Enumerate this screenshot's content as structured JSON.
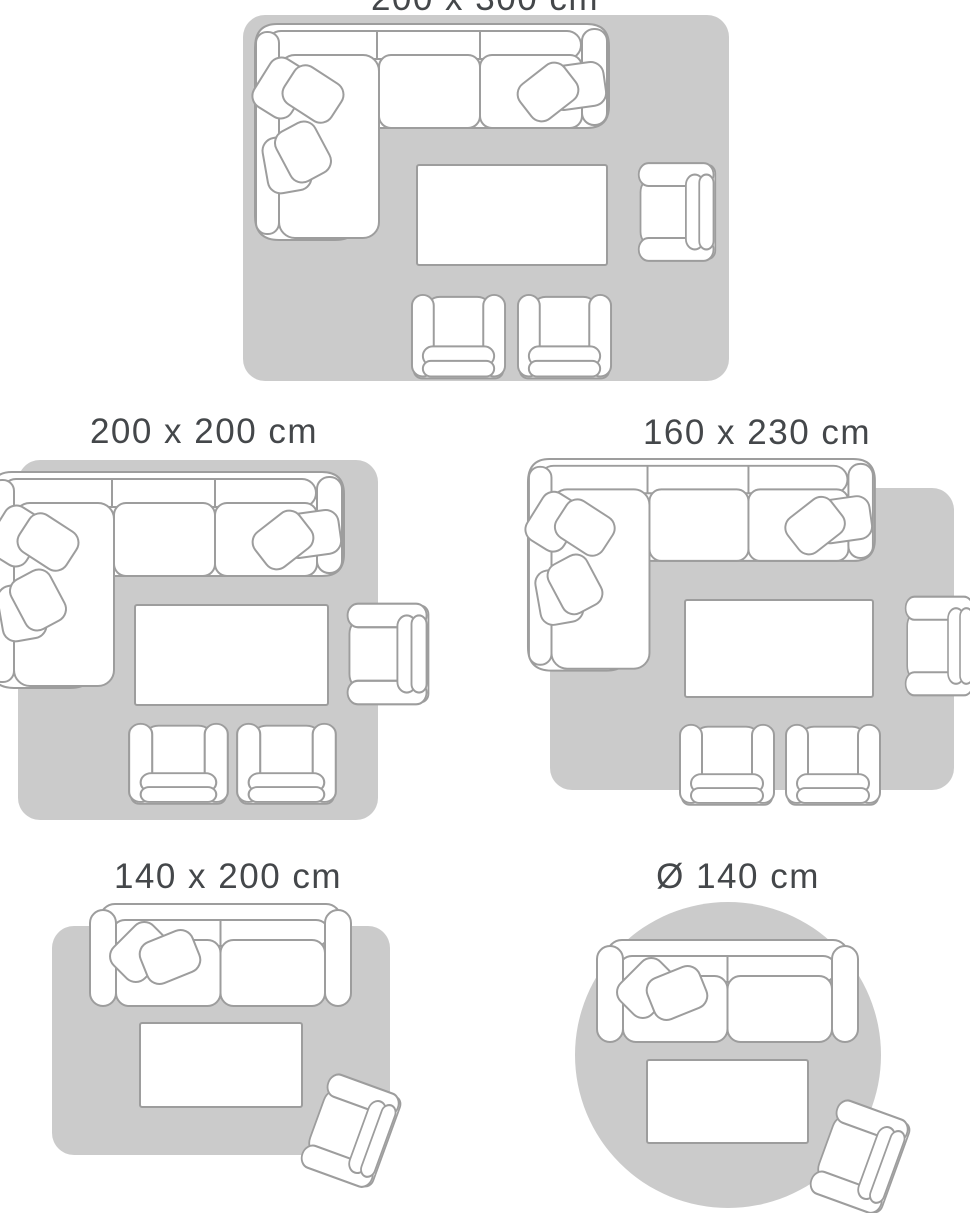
{
  "palette": {
    "background": "#ffffff",
    "rug_fill": "#cbcbcb",
    "furniture_fill": "#ffffff",
    "furniture_stroke": "#9d9d9d",
    "label_color": "#44474a"
  },
  "guide": {
    "diagrams": [
      {
        "label": "200 x 300 cm",
        "rug_shape": "rectangle",
        "label_clipped_at_top": true,
        "furniture": [
          "corner-sofa",
          "coffee-table",
          "armchair",
          "chair",
          "chair"
        ]
      },
      {
        "label": "200 x 200 cm",
        "rug_shape": "square",
        "furniture": [
          "corner-sofa",
          "coffee-table",
          "armchair",
          "chair",
          "chair"
        ]
      },
      {
        "label": "160 x 230 cm",
        "rug_shape": "rectangle",
        "furniture": [
          "corner-sofa",
          "coffee-table",
          "armchair",
          "chair",
          "chair"
        ]
      },
      {
        "label": "140 x 200 cm",
        "rug_shape": "rectangle",
        "furniture": [
          "two-seat-sofa",
          "coffee-table",
          "armchair"
        ]
      },
      {
        "label": "Ø 140 cm",
        "rug_shape": "circle",
        "furniture": [
          "two-seat-sofa",
          "coffee-table",
          "armchair"
        ]
      }
    ]
  }
}
